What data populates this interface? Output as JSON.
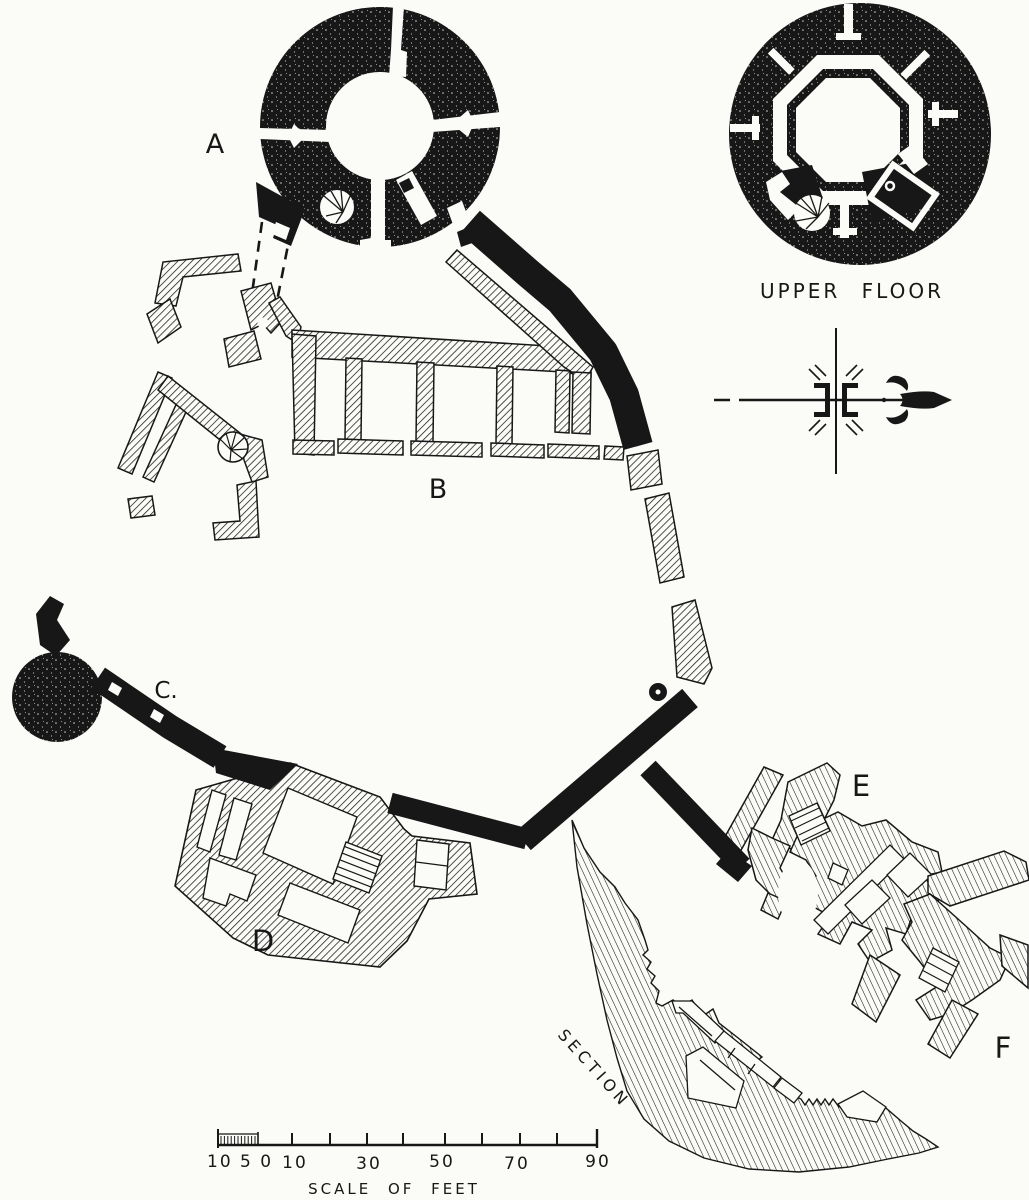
{
  "sheet": {
    "plan_labels": {
      "a": "A",
      "b": "B",
      "c": "C.",
      "d": "D",
      "e": "E",
      "f": "F"
    },
    "upper_floor": {
      "caption": "UPPER FLOOR"
    },
    "section": {
      "caption": "SECTION"
    },
    "scale_bar": {
      "left_label": "10 5 0",
      "tick_labels": [
        "10",
        "30",
        "50",
        "70",
        "90"
      ],
      "caption": "SCALE OF FEET"
    },
    "colors": {
      "ink": "#171717",
      "paper": "#fbfbf8"
    }
  }
}
